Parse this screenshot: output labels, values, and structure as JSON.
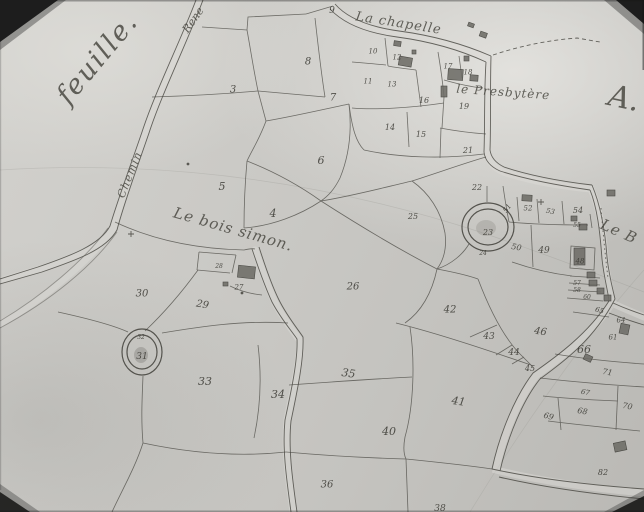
{
  "map": {
    "type": "scanned cadastral map photograph",
    "colors": {
      "paper": "#c9c8c4",
      "ink": "#3d3c36",
      "photo_border": "#141413"
    },
    "place_labels": [
      {
        "id": "feuille",
        "text": "feuille.",
        "x": 104,
        "y": 64,
        "size": 27,
        "rotate": -50,
        "spacing": 2
      },
      {
        "id": "road-name-top",
        "text": "Rene",
        "x": 196,
        "y": 22,
        "size": 11,
        "rotate": -55,
        "spacing": 0
      },
      {
        "id": "la-chapelle",
        "text": "La chapelle",
        "x": 398,
        "y": 27,
        "size": 13,
        "rotate": 9,
        "spacing": 1
      },
      {
        "id": "le-presbytere",
        "text": "le Presbytère",
        "x": 503,
        "y": 96,
        "size": 12,
        "rotate": 4,
        "spacing": 1
      },
      {
        "id": "section-letter",
        "text": "A.",
        "x": 622,
        "y": 108,
        "size": 30,
        "rotate": 12,
        "spacing": 0
      },
      {
        "id": "chemin",
        "text": "Chemin",
        "x": 133,
        "y": 176,
        "size": 11,
        "rotate": -68,
        "spacing": 1
      },
      {
        "id": "le-bois-simon",
        "text": "Le bois simon.",
        "x": 232,
        "y": 234,
        "size": 15,
        "rotate": 16,
        "spacing": 1
      },
      {
        "id": "le-b",
        "text": "Le B",
        "x": 617,
        "y": 236,
        "size": 15,
        "rotate": 24,
        "spacing": 1
      }
    ],
    "parcels": [
      {
        "n": "3",
        "x": 233,
        "y": 89,
        "s": 10
      },
      {
        "n": "4",
        "x": 273,
        "y": 213,
        "s": 11
      },
      {
        "n": "5",
        "x": 222,
        "y": 186,
        "s": 11
      },
      {
        "n": "6",
        "x": 321,
        "y": 160,
        "s": 11
      },
      {
        "n": "7",
        "x": 333,
        "y": 97,
        "s": 10
      },
      {
        "n": "8",
        "x": 308,
        "y": 61,
        "s": 10
      },
      {
        "n": "9",
        "x": 332,
        "y": 10,
        "s": 9
      },
      {
        "n": "10",
        "x": 373,
        "y": 51,
        "s": 7
      },
      {
        "n": "12",
        "x": 397,
        "y": 57,
        "s": 7
      },
      {
        "n": "11",
        "x": 368,
        "y": 81,
        "s": 7
      },
      {
        "n": "13",
        "x": 392,
        "y": 84,
        "s": 7
      },
      {
        "n": "16",
        "x": 424,
        "y": 100,
        "s": 8
      },
      {
        "n": "14",
        "x": 390,
        "y": 127,
        "s": 8
      },
      {
        "n": "15",
        "x": 421,
        "y": 134,
        "s": 8
      },
      {
        "n": "17",
        "x": 448,
        "y": 66,
        "s": 7
      },
      {
        "n": "18",
        "x": 468,
        "y": 72,
        "s": 7
      },
      {
        "n": "19",
        "x": 464,
        "y": 106,
        "s": 8
      },
      {
        "n": "21",
        "x": 468,
        "y": 150,
        "s": 8
      },
      {
        "n": "22",
        "x": 477,
        "y": 187,
        "s": 8
      },
      {
        "n": "23",
        "x": 488,
        "y": 232,
        "s": 8
      },
      {
        "n": "24",
        "x": 483,
        "y": 253,
        "s": 6
      },
      {
        "n": "25",
        "x": 413,
        "y": 216,
        "s": 8
      },
      {
        "n": "26",
        "x": 353,
        "y": 286,
        "s": 10
      },
      {
        "n": "27",
        "x": 239,
        "y": 287,
        "s": 7
      },
      {
        "n": "28",
        "x": 219,
        "y": 266,
        "s": 6
      },
      {
        "n": "29",
        "x": 202,
        "y": 304,
        "s": 10,
        "r": 10
      },
      {
        "n": "30",
        "x": 142,
        "y": 293,
        "s": 10
      },
      {
        "n": "31",
        "x": 142,
        "y": 356,
        "s": 9
      },
      {
        "n": "32",
        "x": 141,
        "y": 337,
        "s": 6
      },
      {
        "n": "33",
        "x": 205,
        "y": 381,
        "s": 11
      },
      {
        "n": "34",
        "x": 278,
        "y": 394,
        "s": 11
      },
      {
        "n": "35",
        "x": 348,
        "y": 373,
        "s": 11,
        "r": 8
      },
      {
        "n": "36",
        "x": 327,
        "y": 484,
        "s": 10
      },
      {
        "n": "38",
        "x": 440,
        "y": 508,
        "s": 9
      },
      {
        "n": "40",
        "x": 389,
        "y": 431,
        "s": 11
      },
      {
        "n": "41",
        "x": 458,
        "y": 401,
        "s": 11,
        "r": 8
      },
      {
        "n": "42",
        "x": 450,
        "y": 309,
        "s": 10
      },
      {
        "n": "43",
        "x": 489,
        "y": 336,
        "s": 9
      },
      {
        "n": "44",
        "x": 514,
        "y": 352,
        "s": 9
      },
      {
        "n": "45",
        "x": 530,
        "y": 368,
        "s": 8
      },
      {
        "n": "46",
        "x": 540,
        "y": 331,
        "s": 10,
        "r": 8
      },
      {
        "n": "48",
        "x": 580,
        "y": 261,
        "s": 7
      },
      {
        "n": "49",
        "x": 544,
        "y": 250,
        "s": 9
      },
      {
        "n": "50",
        "x": 516,
        "y": 247,
        "s": 8,
        "r": 10
      },
      {
        "n": "51",
        "x": 509,
        "y": 207,
        "s": 7,
        "r": -55
      },
      {
        "n": "52",
        "x": 528,
        "y": 208,
        "s": 7
      },
      {
        "n": "53",
        "x": 550,
        "y": 211,
        "s": 7,
        "r": 10
      },
      {
        "n": "54",
        "x": 578,
        "y": 210,
        "s": 8
      },
      {
        "n": "55",
        "x": 577,
        "y": 225,
        "s": 6
      },
      {
        "n": "57",
        "x": 577,
        "y": 283,
        "s": 6
      },
      {
        "n": "58",
        "x": 577,
        "y": 290,
        "s": 6
      },
      {
        "n": "60",
        "x": 587,
        "y": 297,
        "s": 6
      },
      {
        "n": "65",
        "x": 599,
        "y": 310,
        "s": 7,
        "r": 15
      },
      {
        "n": "64",
        "x": 621,
        "y": 320,
        "s": 7
      },
      {
        "n": "61",
        "x": 613,
        "y": 337,
        "s": 7
      },
      {
        "n": "66",
        "x": 584,
        "y": 349,
        "s": 11
      },
      {
        "n": "71",
        "x": 607,
        "y": 372,
        "s": 8,
        "r": 10
      },
      {
        "n": "67",
        "x": 585,
        "y": 392,
        "s": 7,
        "r": 10
      },
      {
        "n": "68",
        "x": 582,
        "y": 411,
        "s": 8,
        "r": 10
      },
      {
        "n": "69",
        "x": 548,
        "y": 416,
        "s": 8,
        "r": 15
      },
      {
        "n": "70",
        "x": 627,
        "y": 406,
        "s": 8,
        "r": 10
      },
      {
        "n": "82",
        "x": 603,
        "y": 472,
        "s": 8
      }
    ],
    "survey_marks": [
      {
        "type": "cross",
        "x": 541,
        "y": 202
      },
      {
        "type": "cross",
        "x": 131,
        "y": 234
      },
      {
        "type": "dot",
        "x": 188,
        "y": 164
      },
      {
        "type": "dot",
        "x": 242,
        "y": 293
      }
    ]
  }
}
